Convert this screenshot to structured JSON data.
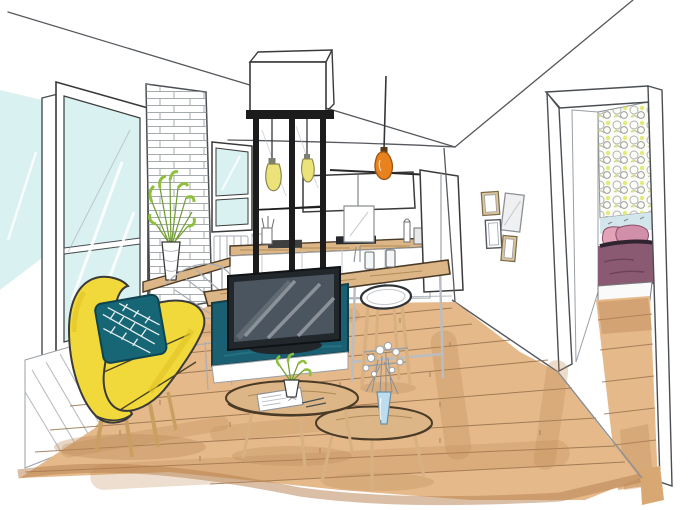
{
  "scene": {
    "kind": "hand-drawn-interior-sketch",
    "room": "open-plan-living-room-kitchen-with-bedroom-doorway"
  },
  "palette": {
    "paper": "#ffffff",
    "line": "#3a3a3a",
    "pencil": "#a8adb5",
    "glass": "#daf1f1",
    "floor": "#e5b98a",
    "floor_shade": "#bd8a57",
    "plank_line": "#96714c",
    "wood": "#dcb686",
    "wood_grain": "#a5824f",
    "armchair": "#f2d93b",
    "armchair_shade": "#e4c62a",
    "cushion": "#176675",
    "tv_panel": "#1b6072",
    "tv_bezel": "#22272b",
    "tv_screen": "#4b5560",
    "metal_frame": "#1c1c1c",
    "pendant": "#e8821e",
    "bulb": "#ece27a",
    "plant": "#8fbf3f",
    "plant_dark": "#6f9c2f",
    "brick_line": "#8a8f94",
    "pattern_accent": "#dde663",
    "blue_band": "#d3e6ec",
    "pillow": "#e2a2b8",
    "pillow_dark": "#d28fa9",
    "blanket": "#8a5a73",
    "vase": "#bcdcef",
    "frame_tan": "#d9c49c"
  },
  "objects": [
    {
      "name": "left-window",
      "desc": "tall window with pale blue glass"
    },
    {
      "name": "wainscot-panel",
      "desc": "hatched panel under window"
    },
    {
      "name": "brick-column",
      "desc": "white brick chimney breast"
    },
    {
      "name": "console-plant",
      "desc": "green plant in white vase"
    },
    {
      "name": "back-window",
      "desc": "small window on back wall"
    },
    {
      "name": "glass-partition",
      "desc": "black metal verriere with bulbs"
    },
    {
      "name": "kitchen-counters",
      "desc": "wood worktops, white cabinets"
    },
    {
      "name": "pendant-lamp",
      "desc": "orange pendant light"
    },
    {
      "name": "kitchen-island",
      "desc": "wood-top island with tv unit"
    },
    {
      "name": "tv",
      "desc": "flat tv on teal media panel"
    },
    {
      "name": "bar-stool",
      "desc": "white round stool"
    },
    {
      "name": "yellow-armchair",
      "desc": "yellow shell chair with teal leaf cushion"
    },
    {
      "name": "coffee-tables",
      "desc": "two nesting oval wood tables"
    },
    {
      "name": "flower-vase",
      "desc": "blue vase with white flowers"
    },
    {
      "name": "picture-frames",
      "desc": "four small wall frames"
    },
    {
      "name": "bedroom-doorway",
      "desc": "doorway to bedroom with patterned wall and pink bed"
    },
    {
      "name": "wood-floor",
      "desc": "light oak plank floor"
    }
  ]
}
